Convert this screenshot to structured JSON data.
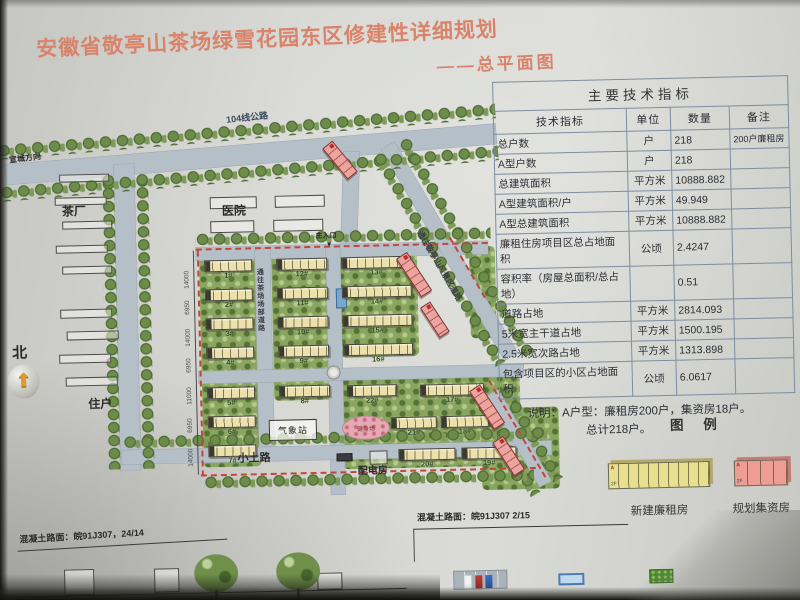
{
  "title": {
    "main": "安徽省敬亭山茶场绿雪花园东区修建性详细规划",
    "sub": "——总平面图"
  },
  "colors": {
    "title": "#d9836a",
    "road": "#b5bfc8",
    "building": "#ece0ad",
    "planned_building": "#eda39e",
    "boundary_dash": "#c4453a",
    "legend_yellow": "#e9e08f",
    "legend_pink": "#ee9d95"
  },
  "table": {
    "title": "主要技术指标",
    "headers": [
      "技术指标",
      "单位",
      "数量",
      "备注"
    ],
    "rows": [
      [
        "总户数",
        "户",
        "218",
        "200户廉租房"
      ],
      [
        "A型户数",
        "户",
        "218",
        ""
      ],
      [
        "总建筑面积",
        "平方米",
        "10888.882",
        ""
      ],
      [
        "A型建筑面积/户",
        "平方米",
        "49.949",
        ""
      ],
      [
        "A型总建筑面积",
        "平方米",
        "10888.882",
        ""
      ],
      [
        "廉租住房项目区总占地面积",
        "公顷",
        "2.4247",
        ""
      ],
      [
        "容积率（房屋总面积/总占地）",
        "",
        "0.51",
        ""
      ],
      [
        "道路占地",
        "平方米",
        "2814.093",
        ""
      ],
      [
        "5米宽主干道占地",
        "平方米",
        "1500.195",
        ""
      ],
      [
        "2.5米宽次路占地",
        "平方米",
        "1313.898",
        ""
      ],
      [
        "包含项目区的小区占地面积",
        "公顷",
        "6.0617",
        ""
      ]
    ],
    "note_line1": "说明：A户型：廉租房200户，集资房18户。",
    "note_line2": "总计218户。"
  },
  "legend": {
    "title": "图 例",
    "items": [
      {
        "label": "新建廉租房",
        "color": "#e9e08f",
        "shadow": "#b3a96a",
        "segments": 10,
        "segw": 10,
        "tag": "A",
        "floors": "2F"
      },
      {
        "label": "规划集资房",
        "color": "#ee9d95",
        "shadow": "#c47d75",
        "segments": 4,
        "segw": 13,
        "tag": "A",
        "floors": "2F"
      }
    ]
  },
  "map": {
    "items": [
      {
        "t": "green",
        "x": 200,
        "y": 250,
        "w": 58,
        "h": 213
      },
      {
        "t": "green",
        "x": 272,
        "y": 250,
        "w": 58,
        "h": 148
      },
      {
        "t": "green",
        "x": 338,
        "y": 250,
        "w": 80,
        "h": 106
      },
      {
        "t": "green",
        "x": 340,
        "y": 378,
        "w": 178,
        "h": 90
      },
      {
        "t": "green",
        "x": 470,
        "y": 248,
        "w": 26,
        "h": 92
      },
      {
        "t": "green",
        "x": 478,
        "y": 410,
        "w": 78,
        "h": 82
      },
      {
        "t": "road",
        "x": 8,
        "y": 156,
        "w": 492,
        "h": 20,
        "r": -3.5
      },
      {
        "t": "road",
        "x": 117,
        "y": 158,
        "w": 20,
        "h": 306
      },
      {
        "t": "road",
        "x": 347,
        "y": 150,
        "w": 16,
        "h": 98,
        "r": 3
      },
      {
        "t": "road",
        "x": 197,
        "y": 243,
        "w": 292,
        "h": 13
      },
      {
        "t": "road",
        "x": 256,
        "y": 246,
        "w": 15,
        "h": 212
      },
      {
        "t": "road",
        "x": 327,
        "y": 243,
        "w": 14,
        "h": 250
      },
      {
        "t": "road",
        "x": 197,
        "y": 367,
        "w": 325,
        "h": 12
      },
      {
        "t": "road",
        "x": 118,
        "y": 444,
        "w": 430,
        "h": 14
      },
      {
        "t": "road",
        "x": 398,
        "y": 142,
        "w": 244,
        "h": 15,
        "r": 61
      },
      {
        "t": "road",
        "x": 496,
        "y": 392,
        "w": 105,
        "h": 13,
        "r": 61
      },
      {
        "t": "trees",
        "x": 0,
        "y": 136,
        "w": 500,
        "h": 15,
        "r": -3.5
      },
      {
        "t": "trees",
        "x": 2,
        "y": 178,
        "w": 500,
        "h": 15,
        "r": -3.5
      },
      {
        "t": "trees",
        "x": 104,
        "y": 168,
        "w": 13,
        "h": 295
      },
      {
        "t": "trees",
        "x": 138,
        "y": 168,
        "w": 13,
        "h": 295
      },
      {
        "t": "trees",
        "x": 386,
        "y": 150,
        "w": 244,
        "h": 13,
        "r": 61
      },
      {
        "t": "trees",
        "x": 412,
        "y": 136,
        "w": 250,
        "h": 13,
        "r": 61
      },
      {
        "t": "trees",
        "x": 484,
        "y": 400,
        "w": 108,
        "h": 12,
        "r": 61
      },
      {
        "t": "trees",
        "x": 507,
        "y": 386,
        "w": 108,
        "h": 12,
        "r": 61
      },
      {
        "t": "trees",
        "x": 197,
        "y": 229,
        "w": 295,
        "h": 13
      },
      {
        "t": "trees",
        "x": 120,
        "y": 430,
        "w": 424,
        "h": 13
      },
      {
        "t": "trees",
        "x": 200,
        "y": 472,
        "w": 330,
        "h": 13
      },
      {
        "t": "dash",
        "x": 197,
        "y": 244,
        "w": 292
      },
      {
        "t": "dashv",
        "x": 198,
        "y": 246,
        "h": 226
      },
      {
        "t": "dash",
        "x": 197,
        "y": 470,
        "w": 335
      },
      {
        "t": "dash",
        "x": 452,
        "y": 238,
        "w": 70,
        "r": 61
      },
      {
        "t": "dash",
        "x": 488,
        "y": 382,
        "w": 112,
        "r": 61
      },
      {
        "t": "vline",
        "x": 194,
        "y": 246,
        "h": 224
      },
      {
        "t": "out",
        "x": 62,
        "y": 167,
        "w": 50,
        "h": 8
      },
      {
        "t": "out",
        "x": 57,
        "y": 190,
        "w": 52,
        "h": 8
      },
      {
        "t": "out",
        "x": 64,
        "y": 214,
        "w": 50,
        "h": 8
      },
      {
        "t": "out",
        "x": 57,
        "y": 238,
        "w": 52,
        "h": 8
      },
      {
        "t": "out",
        "x": 63,
        "y": 259,
        "w": 50,
        "h": 8
      },
      {
        "t": "out",
        "x": 60,
        "y": 302,
        "w": 52,
        "h": 9
      },
      {
        "t": "out",
        "x": 66,
        "y": 324,
        "w": 52,
        "h": 9
      },
      {
        "t": "out",
        "x": 58,
        "y": 347,
        "w": 52,
        "h": 9
      },
      {
        "t": "out",
        "x": 64,
        "y": 370,
        "w": 52,
        "h": 9
      },
      {
        "t": "out",
        "x": 212,
        "y": 193,
        "w": 47,
        "h": 12
      },
      {
        "t": "out",
        "x": 277,
        "y": 193,
        "w": 50,
        "h": 12
      },
      {
        "t": "out",
        "x": 212,
        "y": 217,
        "w": 44,
        "h": 12
      },
      {
        "t": "out",
        "x": 275,
        "y": 217,
        "w": 50,
        "h": 12
      },
      {
        "t": "out",
        "x": 366,
        "y": 450,
        "w": 18,
        "h": 14
      },
      {
        "t": "out",
        "x": 58,
        "y": 562,
        "w": 30,
        "h": 26
      },
      {
        "t": "out",
        "x": 148,
        "y": 563,
        "w": 25,
        "h": 24
      },
      {
        "t": "out",
        "x": 311,
        "y": 571,
        "w": 25,
        "h": 17
      },
      {
        "t": "outbox",
        "x": 266,
        "y": 417,
        "w": 48,
        "h": 21,
        "text": "气象站"
      },
      {
        "t": "oval",
        "x": 339,
        "y": 415,
        "w": 48,
        "h": 24,
        "text": "健身场"
      },
      {
        "t": "circle",
        "x": 325,
        "y": 364,
        "w": 14,
        "h": 14
      },
      {
        "t": "bluebox",
        "x": 336,
        "y": 287,
        "w": 11,
        "h": 20
      },
      {
        "t": "darkbox",
        "x": 333,
        "y": 452,
        "w": 16,
        "h": 8
      },
      {
        "t": "bldg",
        "x": 205,
        "y": 256,
        "w": 48,
        "h": 12,
        "text": "1#"
      },
      {
        "t": "bldg",
        "x": 205,
        "y": 285,
        "w": 48,
        "h": 12,
        "text": "2#"
      },
      {
        "t": "bldg",
        "x": 205,
        "y": 314,
        "w": 48,
        "h": 12,
        "text": "3#"
      },
      {
        "t": "bldg",
        "x": 205,
        "y": 343,
        "w": 48,
        "h": 12,
        "text": "4#"
      },
      {
        "t": "bldg",
        "x": 205,
        "y": 383,
        "w": 48,
        "h": 12,
        "text": "5#"
      },
      {
        "t": "bldg",
        "x": 205,
        "y": 412,
        "w": 48,
        "h": 12,
        "text": "6#"
      },
      {
        "t": "bldg",
        "x": 205,
        "y": 441,
        "w": 48,
        "h": 12,
        "text": "7#"
      },
      {
        "t": "bldg",
        "x": 277,
        "y": 256,
        "w": 51,
        "h": 12,
        "text": "12#"
      },
      {
        "t": "bldg",
        "x": 277,
        "y": 285,
        "w": 51,
        "h": 12,
        "text": "11#"
      },
      {
        "t": "bldg",
        "x": 277,
        "y": 314,
        "w": 51,
        "h": 12,
        "text": "10#"
      },
      {
        "t": "bldg",
        "x": 277,
        "y": 343,
        "w": 51,
        "h": 12,
        "text": "9#"
      },
      {
        "t": "bldg",
        "x": 277,
        "y": 383,
        "w": 51,
        "h": 12,
        "text": "8#"
      },
      {
        "t": "bldg",
        "x": 342,
        "y": 256,
        "w": 70,
        "h": 12,
        "text": "13#"
      },
      {
        "t": "bldg",
        "x": 342,
        "y": 285,
        "w": 70,
        "h": 12,
        "text": "14#"
      },
      {
        "t": "bldg",
        "x": 342,
        "y": 314,
        "w": 70,
        "h": 12,
        "text": "15#"
      },
      {
        "t": "bldg",
        "x": 342,
        "y": 343,
        "w": 70,
        "h": 12,
        "text": "16#"
      },
      {
        "t": "bldg",
        "x": 345,
        "y": 384,
        "w": 50,
        "h": 12,
        "text": "22#"
      },
      {
        "t": "bldg",
        "x": 418,
        "y": 385,
        "w": 64,
        "h": 12,
        "text": "17#"
      },
      {
        "t": "bldg",
        "x": 388,
        "y": 417,
        "w": 46,
        "h": 12,
        "text": "21#"
      },
      {
        "t": "bldg",
        "x": 438,
        "y": 417,
        "w": 48,
        "h": 12,
        "text": "18#"
      },
      {
        "t": "bldg",
        "x": 395,
        "y": 449,
        "w": 57,
        "h": 12,
        "text": "20#"
      },
      {
        "t": "bldg",
        "x": 458,
        "y": 449,
        "w": 55,
        "h": 12,
        "text": "19#"
      },
      {
        "t": "pink",
        "x": 336,
        "y": 139,
        "w": 40,
        "h": 13,
        "r": 52
      },
      {
        "t": "pink",
        "x": 408,
        "y": 252,
        "w": 46,
        "h": 13,
        "r": 58
      },
      {
        "t": "pink",
        "x": 430,
        "y": 302,
        "w": 36,
        "h": 12,
        "r": 58
      },
      {
        "t": "pink",
        "x": 478,
        "y": 386,
        "w": 46,
        "h": 13,
        "r": 58
      },
      {
        "t": "pink",
        "x": 500,
        "y": 438,
        "w": 40,
        "h": 13,
        "r": 58
      },
      {
        "t": "compass",
        "x": 6,
        "y": 356,
        "w": 32,
        "h": 34,
        "text": "⬆"
      },
      {
        "t": "btree",
        "x": 188,
        "y": 550,
        "w": 44,
        "h": 38
      },
      {
        "t": "btree",
        "x": 270,
        "y": 550,
        "w": 44,
        "h": 38
      },
      {
        "t": "parking",
        "x": 447,
        "y": 572,
        "w": 54,
        "h": 19
      },
      {
        "t": "bluebox2",
        "x": 552,
        "y": 577,
        "w": 26,
        "h": 12
      },
      {
        "t": "grass",
        "x": 643,
        "y": 575,
        "w": 24,
        "h": 14
      },
      {
        "t": "hline",
        "x": 10,
        "y": 588,
        "w": 390
      },
      {
        "t": "hline",
        "x": 408,
        "y": 529,
        "w": 215
      },
      {
        "t": "hline",
        "x": 12,
        "y": 542,
        "w": 210,
        "r": -2
      },
      {
        "t": "vline",
        "x": 408,
        "y": 529,
        "h": 33
      },
      {
        "t": "lbl",
        "text": "茶厂",
        "x": 64,
        "y": 198,
        "fs": 12
      },
      {
        "t": "lbl",
        "text": "医院",
        "x": 224,
        "y": 201,
        "fs": 12
      },
      {
        "t": "lbl",
        "text": "住户",
        "x": 86,
        "y": 391,
        "fs": 12
      },
      {
        "t": "lbl",
        "text": "小土路",
        "x": 234,
        "y": 450,
        "fs": 11
      },
      {
        "t": "lbl",
        "text": "配电房",
        "x": 354,
        "y": 466,
        "fs": 10
      },
      {
        "t": "lbl",
        "text": "主入口",
        "x": 317,
        "y": 231,
        "fs": 7
      },
      {
        "t": "lbl",
        "text": "▼",
        "x": 327,
        "y": 240,
        "fs": 7
      },
      {
        "t": "lbl",
        "text": "宣城方向",
        "x": 12,
        "y": 148,
        "fs": 8,
        "r": -6
      },
      {
        "t": "lbl",
        "text": "104线公路",
        "x": 230,
        "y": 112,
        "fs": 9,
        "r": -5,
        "c": "#3b4a5c"
      },
      {
        "t": "lbl",
        "text": "通往茶场场部道路",
        "x": 257,
        "y": 265,
        "fs": 7,
        "vert": true,
        "c": "#3c3c46"
      },
      {
        "t": "lbl",
        "text": "通往敬亭山风景区道路",
        "x": 424,
        "y": 230,
        "fs": 8,
        "r": 61,
        "c": "#3c3c46"
      },
      {
        "t": "lbl",
        "text": "北",
        "x": 11,
        "y": 337,
        "fs": 15,
        "bold": true
      },
      {
        "t": "lbl",
        "text": "混凝土路面：皖91J307，24/14",
        "x": 14,
        "y": 527,
        "fs": 9,
        "r": -2
      },
      {
        "t": "lbl",
        "text": "混凝土路面：皖91J307 2/15",
        "x": 412,
        "y": 514,
        "fs": 9
      },
      {
        "t": "dim",
        "text": "14000",
        "x": 184,
        "y": 284
      },
      {
        "t": "dim",
        "text": "6950",
        "x": 184,
        "y": 310
      },
      {
        "t": "dim",
        "text": "14000",
        "x": 184,
        "y": 342
      },
      {
        "t": "dim",
        "text": "6950",
        "x": 184,
        "y": 368
      },
      {
        "t": "dim",
        "text": "11000",
        "x": 184,
        "y": 400
      },
      {
        "t": "dim",
        "text": "6950",
        "x": 184,
        "y": 428
      },
      {
        "t": "dim",
        "text": "14000",
        "x": 184,
        "y": 462
      }
    ]
  }
}
